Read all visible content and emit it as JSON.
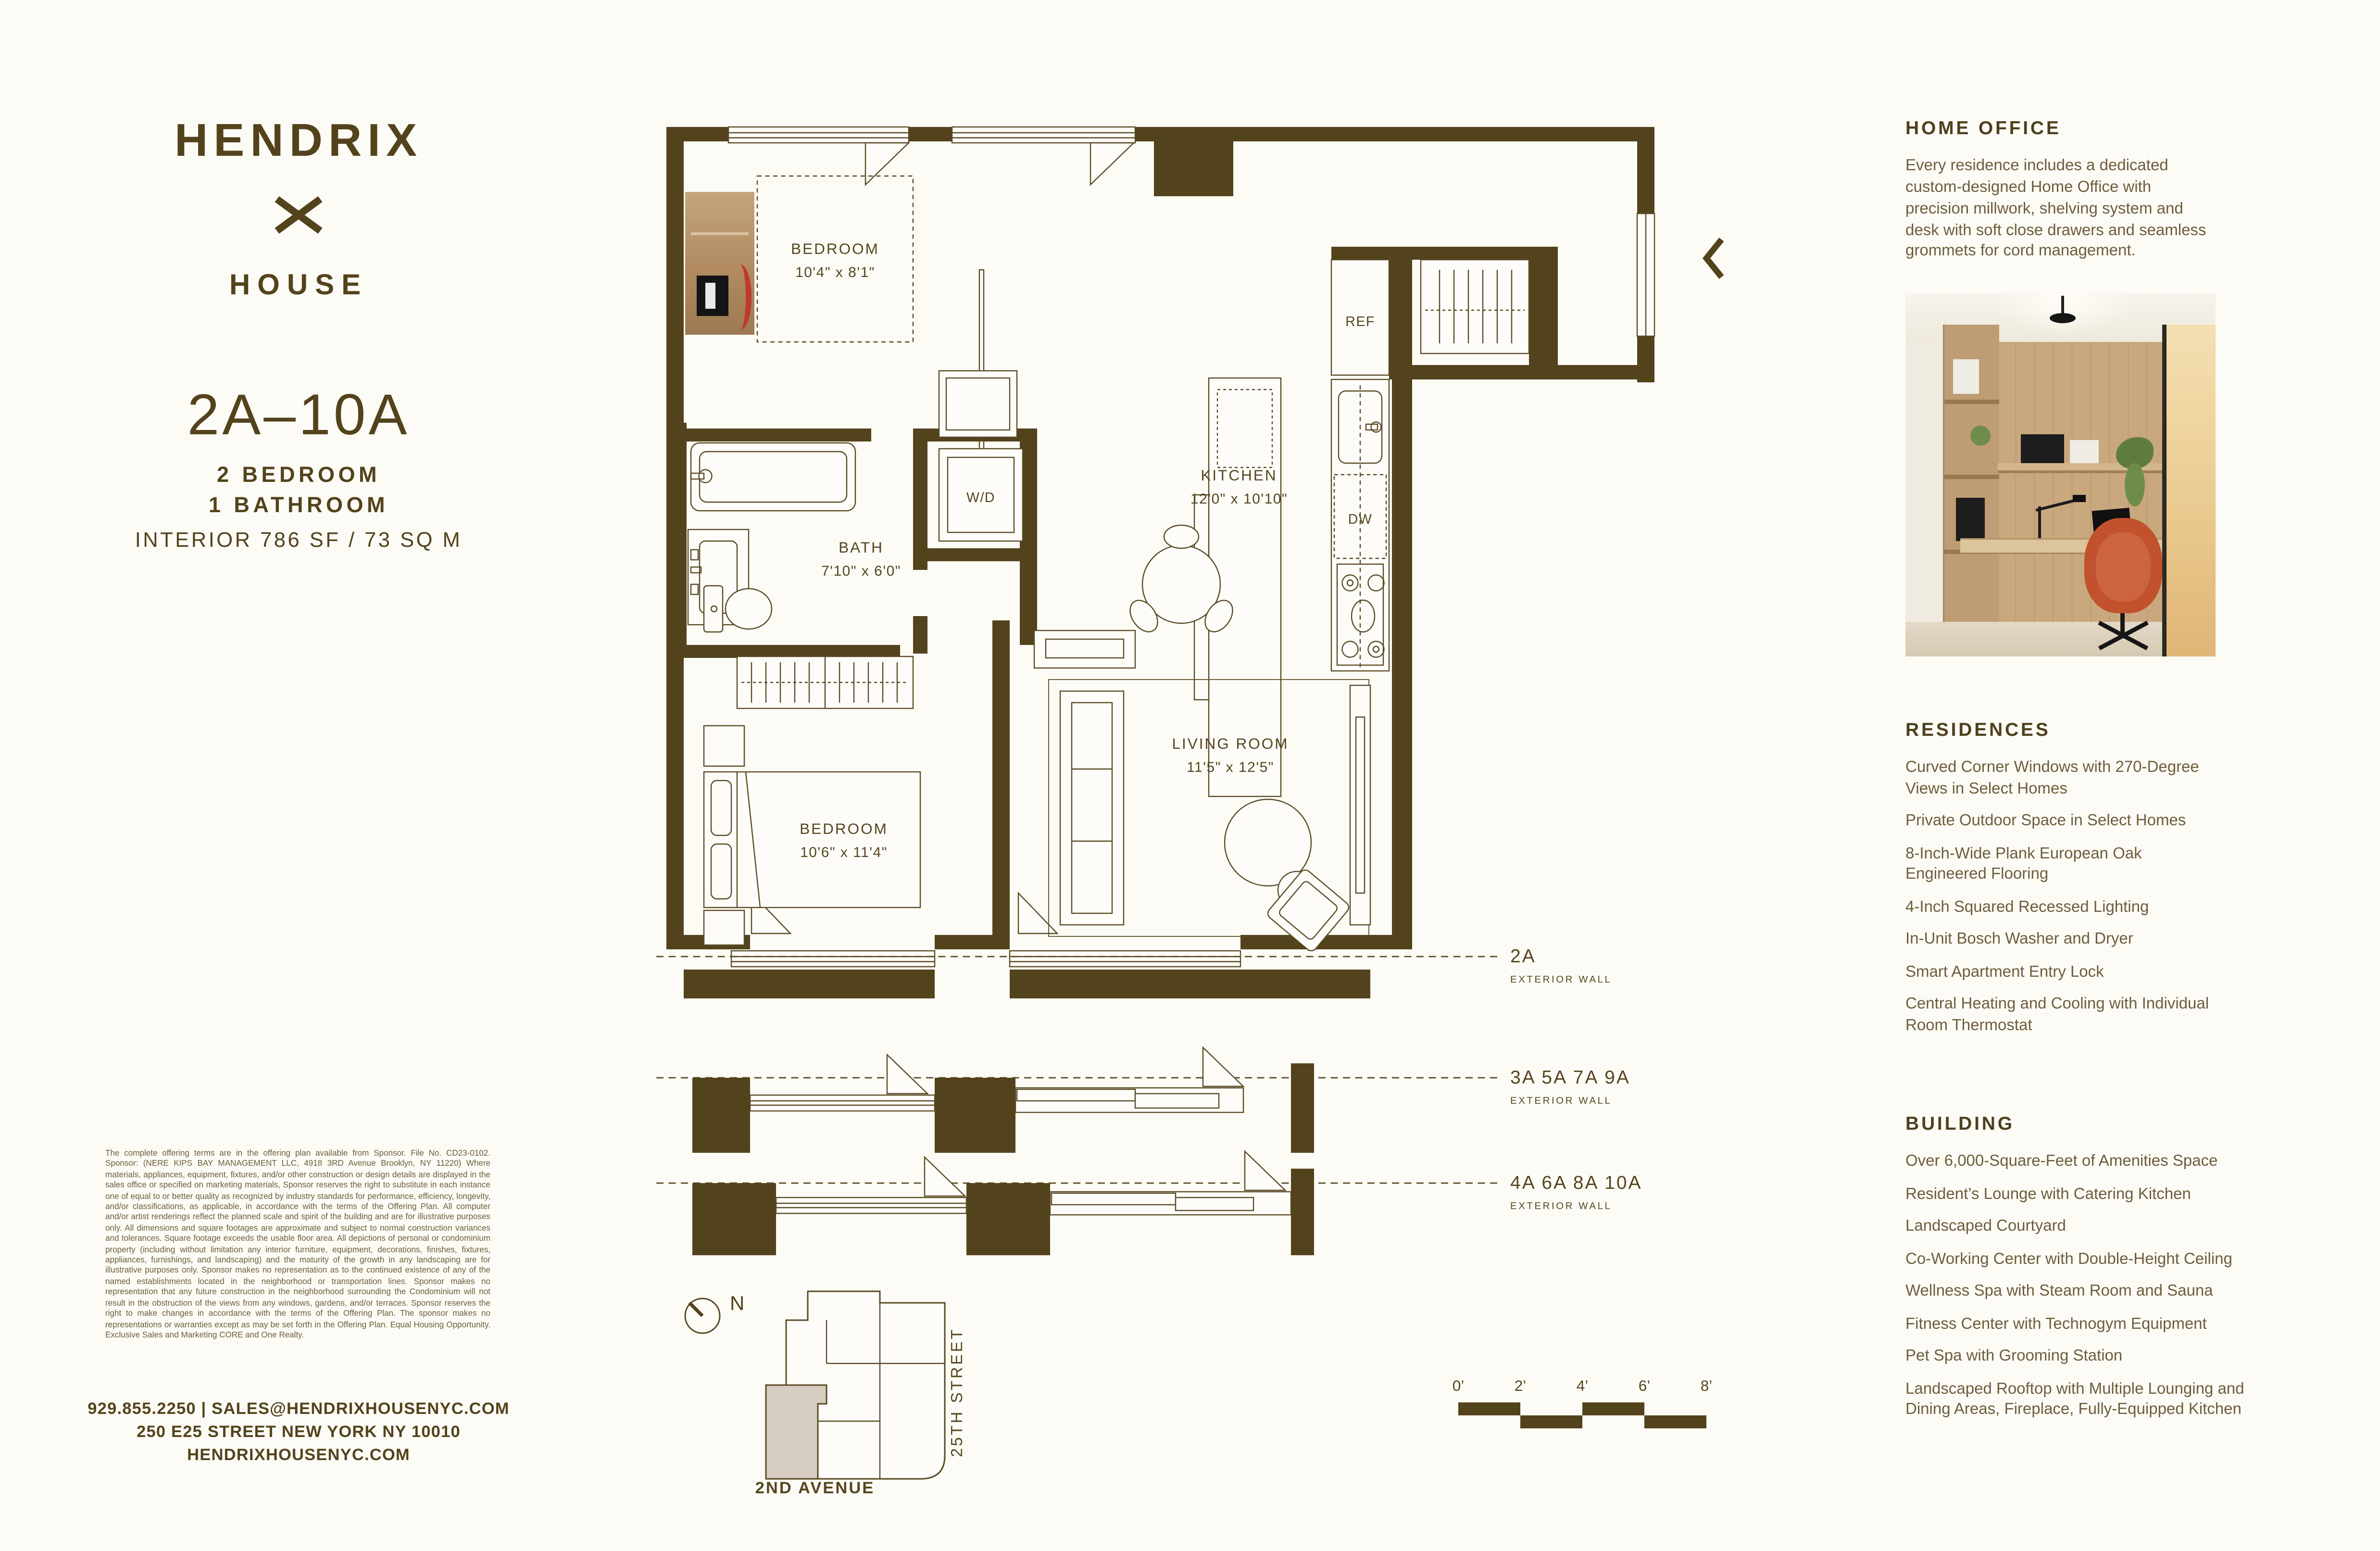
{
  "colors": {
    "background": "#fcfbf5",
    "brand_brown": "#53431c",
    "line_brown": "#5a4a24",
    "body_text": "#6e5d3c",
    "keyplan_fill": "#d6cec0",
    "accent_red": "#c0392b",
    "chair_orange": "#c2512d"
  },
  "brand": {
    "name": "HENDRIX",
    "mark": "x-logo",
    "sub": "HOUSE"
  },
  "unit": {
    "id": "2A–10A",
    "line1": "2 BEDROOM",
    "line2": "1 BATHROOM",
    "area": "INTERIOR 786 SF / 73 SQ M"
  },
  "plan": {
    "bedroom1": {
      "name": "BEDROOM",
      "dims": "10'4\" x 8'1\""
    },
    "bath": {
      "name": "BATH",
      "dims": "7'10\" x 6'0\""
    },
    "wd": "W/D",
    "kitchen": {
      "name": "KITCHEN",
      "dims": "12'0\" x 10'10\""
    },
    "ref": "REF",
    "dw": "DW",
    "living": {
      "name": "LIVING ROOM",
      "dims": "11'5\" x 12'5\""
    },
    "bedroom2": {
      "name": "BEDROOM",
      "dims": "10'6\" x 11'4\""
    },
    "walls": [
      {
        "units": "2A",
        "label": "EXTERIOR WALL"
      },
      {
        "units": "3A 5A 7A 9A",
        "label": "EXTERIOR WALL"
      },
      {
        "units": "4A 6A 8A 10A",
        "label": "EXTERIOR WALL"
      }
    ]
  },
  "keyplan": {
    "north": "N",
    "street_side": "25TH STREET",
    "street_bottom": "2ND AVENUE"
  },
  "scale_bar": {
    "ticks": [
      "0’",
      "2’",
      "4’",
      "6’",
      "8’"
    ]
  },
  "sidebar": {
    "home_office": {
      "heading": "HOME OFFICE",
      "body": "Every residence includes a dedicated\ncustom-designed Home Office with\nprecision millwork, shelving system and\ndesk with soft close drawers and seamless\ngrommets for cord management."
    },
    "residences": {
      "heading": "RESIDENCES",
      "items": [
        "Curved Corner Windows with 270-Degree\nViews in Select Homes",
        "Private Outdoor Space in Select Homes",
        "8-Inch-Wide Plank European Oak\nEngineered Flooring",
        "4-Inch Squared Recessed Lighting",
        "In-Unit Bosch Washer and Dryer",
        "Smart Apartment Entry Lock",
        "Central Heating and Cooling with Individual\nRoom Thermostat"
      ]
    },
    "building": {
      "heading": "BUILDING",
      "items": [
        "Over 6,000-Square-Feet of Amenities Space",
        "Resident’s Lounge with Catering Kitchen",
        "Landscaped Courtyard",
        "Co-Working Center with Double-Height Ceiling",
        "Wellness Spa with Steam Room and Sauna",
        "Fitness Center with Technogym Equipment",
        "Pet Spa with Grooming Station",
        "Landscaped Rooftop with Multiple Lounging and\nDining Areas, Fireplace, Fully-Equipped Kitchen"
      ]
    }
  },
  "legal": "The complete offering terms are in the offering plan available from Sponsor. File No. CD23-0102. Sponsor: (NERE KIPS BAY MANAGEMENT LLC, 4918 3RD Avenue Brooklyn, NY 11220) Where materials, appliances, equipment, fixtures, and/or other construction or design details are displayed in the sales office or specified on marketing materials, Sponsor reserves the right to substitute in each instance one of equal to or better quality as recognized by industry standards for performance, efficiency, longevity, and/or classifications, as applicable, in accordance with the terms of the Offering Plan. All computer and/or artist renderings reflect the planned scale and spirit of the building and are for illustrative purposes only. All dimensions and square footages are approximate and subject to normal construction variances and tolerances. Square footage exceeds the usable floor area. All depictions of personal or condominium property (including without limitation any interior furniture, equipment, decorations, finishes, fixtures, appliances, furnishings, and landscaping) and the maturity of the growth in any landscaping are for illustrative purposes only. Sponsor makes no representation as to the continued existence of any of the named establishments located in the neighborhood or transportation lines. Sponsor makes no representation that any future construction in the neighborhood surrounding the Condominium will not result in the obstruction of the views from any windows, gardens, and/or terraces. Sponsor reserves the right to make changes in accordance with the terms of the Offering Plan. The sponsor makes no representations or warranties except as may be set forth in the Offering Plan. Equal Housing Opportunity. Exclusive Sales and Marketing CORE and One Realty.",
  "contact": {
    "line1": "929.855.2250 | SALES@HENDRIXHOUSENYC.COM",
    "line2": "250 E25 STREET NEW YORK NY 10010",
    "line3": "HENDRIXHOUSENYC.COM"
  }
}
